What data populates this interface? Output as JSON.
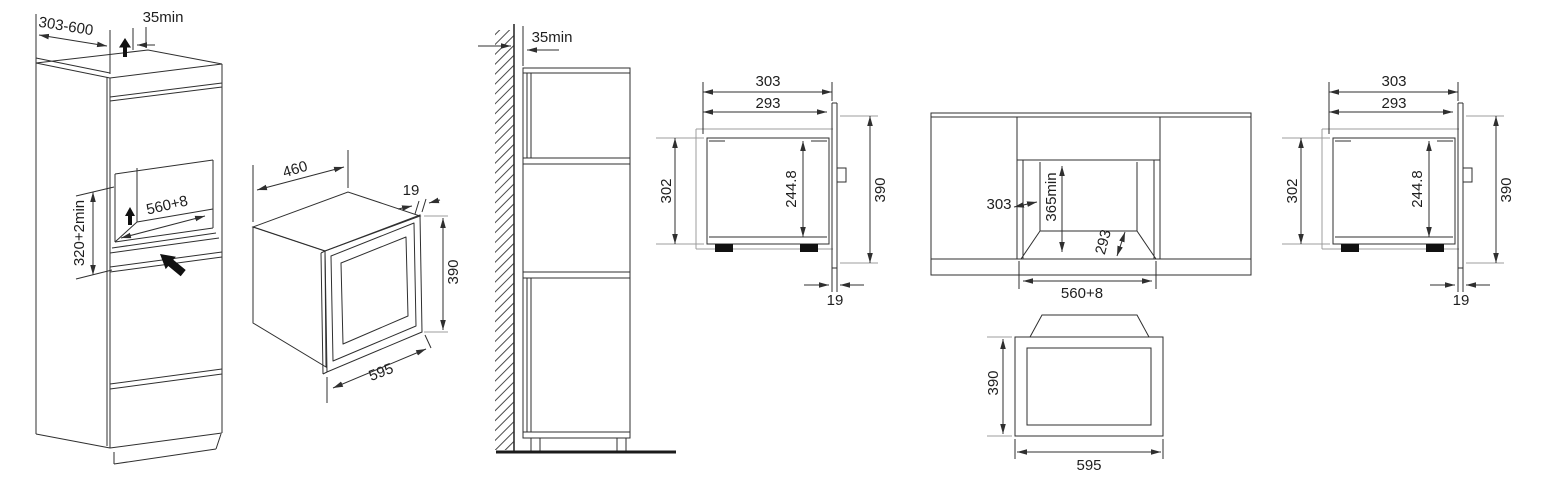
{
  "colors": {
    "background": "#ffffff",
    "line": "#2f2f2f",
    "aux_line": "#9c9c9c",
    "arrow_fill": "#111111"
  },
  "dims": {
    "iso_cabinet": {
      "depth_range": "303-600",
      "top_clearance": "35min",
      "niche_width": "560+8",
      "niche_height": "320+2min"
    },
    "iso_oven": {
      "body_back_width": "460",
      "door_thickness": "19",
      "front_height": "390",
      "front_width": "595"
    },
    "side_cabinet": {
      "wall_clearance": "35min"
    },
    "side_section": {
      "overall_depth": "303",
      "body_depth": "293",
      "body_height": "302",
      "cavity_height": "244.8",
      "front_height": "390",
      "door_thickness": "19"
    },
    "front_cabinet": {
      "niche_side_depth": "303",
      "niche_height": "365min",
      "niche_floor_depth": "293",
      "niche_width": "560+8"
    },
    "front_oven": {
      "front_height": "390",
      "front_width": "595"
    }
  }
}
